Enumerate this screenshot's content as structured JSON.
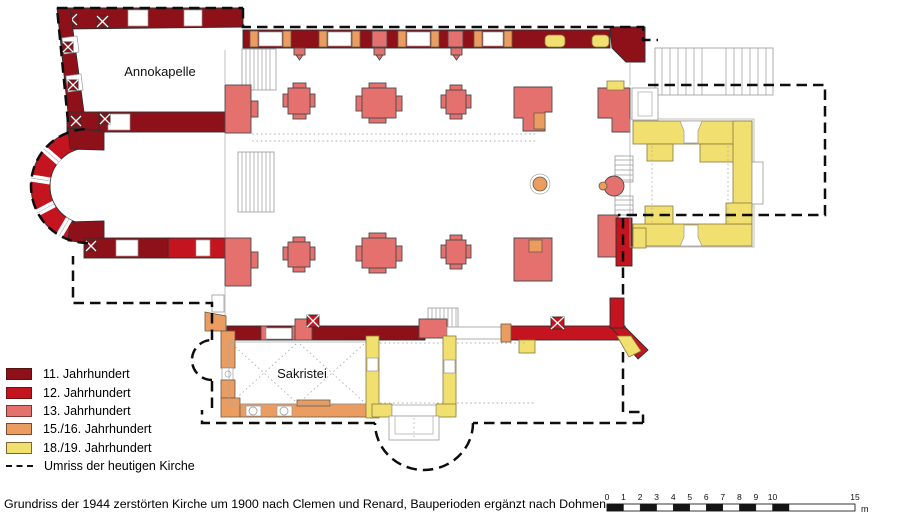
{
  "colors": {
    "c11": "#8e1119",
    "c12": "#c3141f",
    "c13": "#e5716e",
    "c1516": "#ea9c61",
    "c1819": "#f1df70",
    "outline": "#111111"
  },
  "labels": {
    "annokapelle": "Annokapelle",
    "sakristei": "Sakristei"
  },
  "legend": {
    "items": [
      {
        "label": "11. Jahrhundert",
        "color_key": "c11"
      },
      {
        "label": "12. Jahrhundert",
        "color_key": "c12"
      },
      {
        "label": "13. Jahrhundert",
        "color_key": "c13"
      },
      {
        "label": "15./16. Jahrhundert",
        "color_key": "c1516"
      },
      {
        "label": "18./19. Jahrhundert",
        "color_key": "c1819"
      },
      {
        "label": "Umriss der heutigen Kirche",
        "color_key": "dash"
      }
    ]
  },
  "caption": "Grundriss der 1944 zerstörten Kirche um 1900 nach Clemen und Renard, Bauperioden ergänzt nach Dohmen",
  "scalebar": {
    "ticks": [
      "0",
      "1",
      "2",
      "3",
      "4",
      "5",
      "6",
      "7",
      "8",
      "9",
      "10",
      "15"
    ],
    "unit": "m"
  }
}
